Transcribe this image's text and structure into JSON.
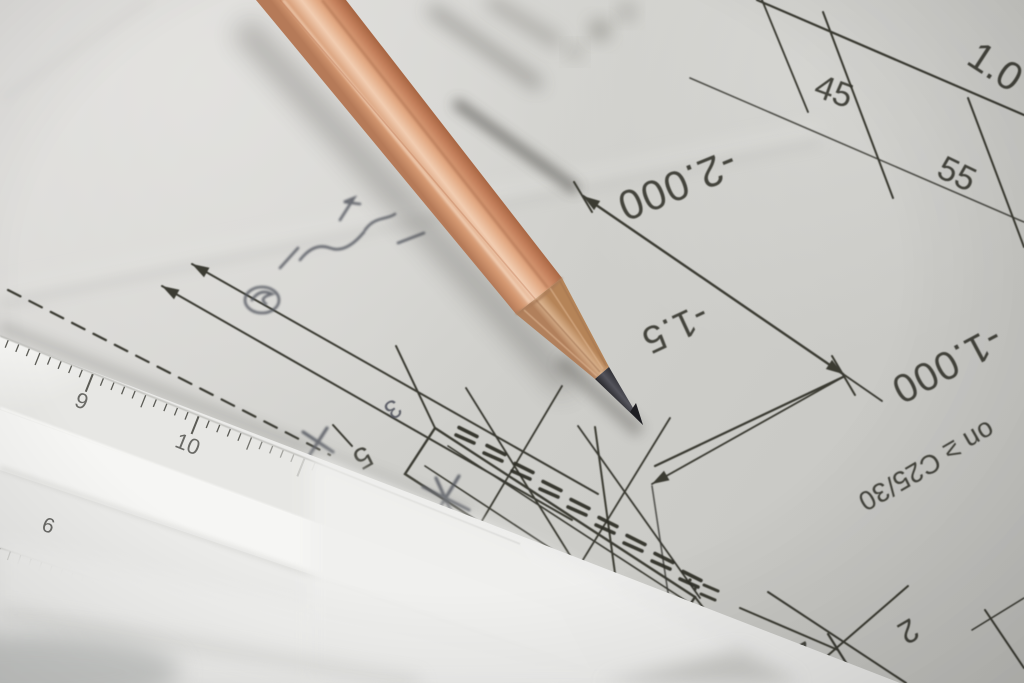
{
  "drawing": {
    "labels": {
      "elevation_top": "-2.000",
      "elevation_mid": "-1.5",
      "elevation_right": "-1.000",
      "dim_chain_top": "1.0",
      "dim_chain_45": "45",
      "dim_chain_55": "55",
      "dim_bottom_25": "25",
      "dim_bottom_2": "2",
      "dim_left_5": "5",
      "note_3": "3",
      "material_spec": "on ≥ C25/30"
    }
  },
  "ruler": {
    "top_scale_numbers": [
      "9",
      "10"
    ],
    "bottom_scale_numbers": [
      "6"
    ]
  },
  "palette": {
    "paper": "#d1d1cd",
    "ink": "#35352e",
    "pencil_wood": "#d89a74",
    "pencil_highlight": "#f3cfb3",
    "pencil_shadow_edge": "#a2613f",
    "sharpened_wood": "#c4936e",
    "graphite": "#323237",
    "ruler_face": "#f3f3f1",
    "handwriting": "#53565f"
  }
}
